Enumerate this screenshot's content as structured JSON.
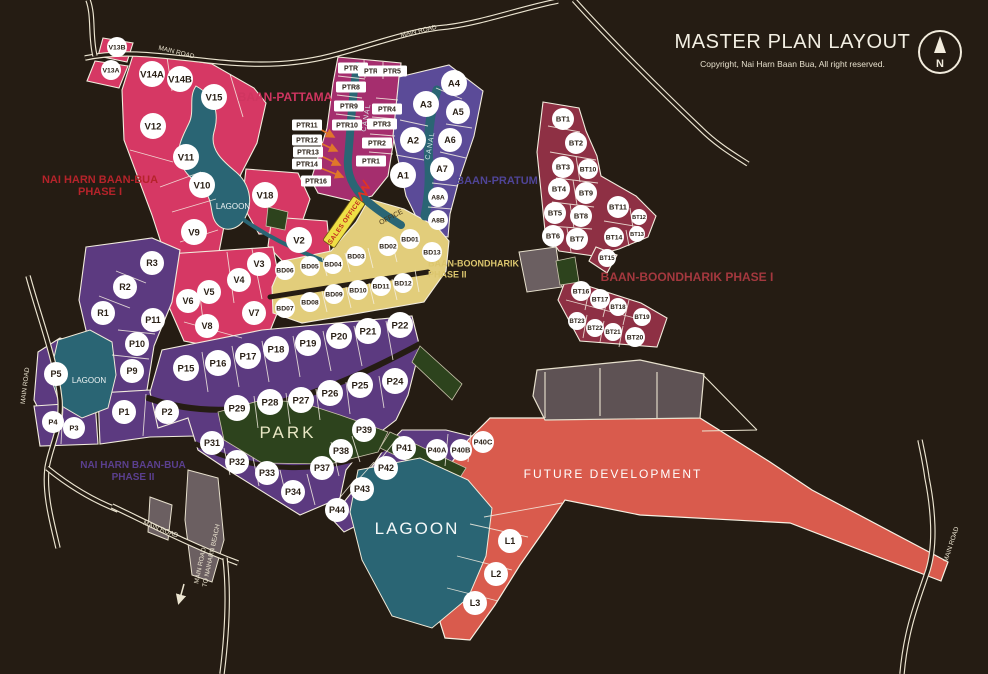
{
  "title": {
    "heading": "MASTER PLAN LAYOUT",
    "copyright": "Copyright, Nai Harn Baan Bua, All right reserved."
  },
  "compass": {
    "label": "N"
  },
  "palette": {
    "bg": "#251c13",
    "pink": "#d63864",
    "magenta": "#a52e6e",
    "purple": "#5b4b98",
    "darkred": "#8e3044",
    "tan": "#e2cd7b",
    "violet": "#5c3a80",
    "teal": "#2a6574",
    "green": "#2d431d",
    "red": "#d95b4d",
    "grey": "#6b5f61",
    "greybrown": "#5e5254",
    "road": "#ece5d1",
    "ink": "#2b2117",
    "orange": "#e0762a",
    "banner": "#efdf45",
    "bannertext": "#c02b20"
  },
  "map": {
    "area_labels": [
      {
        "id": "baan-pattama",
        "text": "BAAN-PATTAMA",
        "color": "#cf3560",
        "size": 12
      },
      {
        "id": "phase1",
        "text": "NAI HARN BAAN-BUA\nPHASE I",
        "color": "#b5232a",
        "size": 11
      },
      {
        "id": "baan-pratum",
        "text": "BAAN-PRATUM",
        "color": "#4f4496",
        "size": 11
      },
      {
        "id": "boondharik1",
        "text": "BAAN-BOONDHARIK PHASE I",
        "color": "#a4383e",
        "size": 12
      },
      {
        "id": "boondharik2",
        "text": "BAAN-BOONDHARIK\nPHASE II",
        "color": "#dcc66e",
        "size": 9
      },
      {
        "id": "phase2",
        "text": "NAI HARN BAAN-BUA\nPHASE II",
        "color": "#5a3f8e",
        "size": 10
      },
      {
        "id": "future",
        "text": "FUTURE DEVELOPMENT",
        "color": "#ffffff",
        "size": 12
      },
      {
        "id": "lagoon-1",
        "text": "LAGOON",
        "color": "#eef4f4",
        "size": 8
      },
      {
        "id": "lagoon-2",
        "text": "LAGOON",
        "color": "#eef4f4",
        "size": 8
      },
      {
        "id": "lagoon-3",
        "text": "LAGOON",
        "color": "#f4f8f8",
        "size": 17
      },
      {
        "id": "park",
        "text": "PARK",
        "color": "#e9e7c4",
        "size": 17
      },
      {
        "id": "canal-1",
        "text": "CANAL",
        "color": "#d8e8e8",
        "size": 7
      },
      {
        "id": "canal-2",
        "text": "CANAL",
        "color": "#d8e8e8",
        "size": 7
      },
      {
        "id": "office",
        "text": "OFFICE",
        "color": "#453517",
        "size": 7
      }
    ],
    "road_labels": [
      {
        "id": "road-top-left",
        "text": "MAIN ROAD"
      },
      {
        "id": "road-top-mid",
        "text": "MAIN ROAD"
      },
      {
        "id": "road-left",
        "text": "MAIN ROAD"
      },
      {
        "id": "road-bottom-diag",
        "text": "MAIN ROAD"
      },
      {
        "id": "road-beach-1",
        "text": "MAIN ROAD"
      },
      {
        "id": "road-beach-2",
        "text": "TO NAIHARN BEACH"
      },
      {
        "id": "road-right",
        "text": "MAIN ROAD"
      }
    ],
    "sales_office_label": "SALES OFFICE",
    "plot_groups": [
      {
        "id": "baan-pattama",
        "name": "Baan-Pattama (V)",
        "color": "#d63864",
        "marker": "circle",
        "plots": [
          "V13B",
          "V13A",
          "V14A",
          "V14B",
          "V15",
          "V12",
          "V11",
          "V10",
          "V18",
          "V9",
          "V2",
          "V3",
          "V4",
          "V5",
          "V6",
          "V7",
          "V8"
        ]
      },
      {
        "id": "ptr",
        "name": "PTR plots",
        "color": "#a52e6e",
        "marker": "rect",
        "plots": [
          "PTR7",
          "PTR6",
          "PTR5",
          "PTR8",
          "PTR9",
          "PTR10",
          "PTR4",
          "PTR3",
          "PTR2",
          "PTR1",
          "PTR11",
          "PTR12",
          "PTR13",
          "PTR14",
          "PTR16"
        ]
      },
      {
        "id": "baan-pratum",
        "name": "Baan-Pratum (A)",
        "color": "#5b4b98",
        "marker": "circle",
        "plots": [
          "A1",
          "A2",
          "A3",
          "A4",
          "A5",
          "A6",
          "A7",
          "A8A",
          "A8B"
        ]
      },
      {
        "id": "baan-boondharik-1",
        "name": "Baan-Boondharik Phase I (BT)",
        "color": "#8e3044",
        "marker": "circle",
        "plots": [
          "BT1",
          "BT2",
          "BT3",
          "BT4",
          "BT5",
          "BT6",
          "BT7",
          "BT8",
          "BT9",
          "BT10",
          "BT11",
          "BT12",
          "BT13",
          "BT14",
          "BT15",
          "BT16",
          "BT17",
          "BT18",
          "BT19",
          "BT20",
          "BT21",
          "BT22",
          "BT23"
        ]
      },
      {
        "id": "baan-boondharik-2",
        "name": "Baan-Boondharik Phase II (BD)",
        "color": "#e2cd7b",
        "marker": "circle",
        "plots": [
          "BD01",
          "BD02",
          "BD03",
          "BD04",
          "BD05",
          "BD06",
          "BD07",
          "BD08",
          "BD09",
          "BD10",
          "BD11",
          "BD12",
          "BD13"
        ]
      },
      {
        "id": "nai-harn-baan-bua",
        "name": "Nai Harn Baan Bua (R/P)",
        "color": "#5c3a80",
        "marker": "circle",
        "plots": [
          "R1",
          "R2",
          "R3",
          "P1",
          "P2",
          "P3",
          "P4",
          "P5",
          "P9",
          "P10",
          "P11",
          "P15",
          "P16",
          "P17",
          "P18",
          "P19",
          "P20",
          "P21",
          "P22",
          "P24",
          "P25",
          "P26",
          "P27",
          "P28",
          "P29",
          "P31",
          "P32",
          "P33",
          "P34",
          "P37",
          "P38",
          "P39",
          "P40A",
          "P40B",
          "P40C",
          "P41",
          "P42",
          "P43",
          "P44"
        ]
      },
      {
        "id": "l-plots",
        "name": "Lagoon-side L plots",
        "color": "#d95b4d",
        "marker": "circle",
        "plots": [
          "L1",
          "L2",
          "L3"
        ]
      }
    ]
  }
}
